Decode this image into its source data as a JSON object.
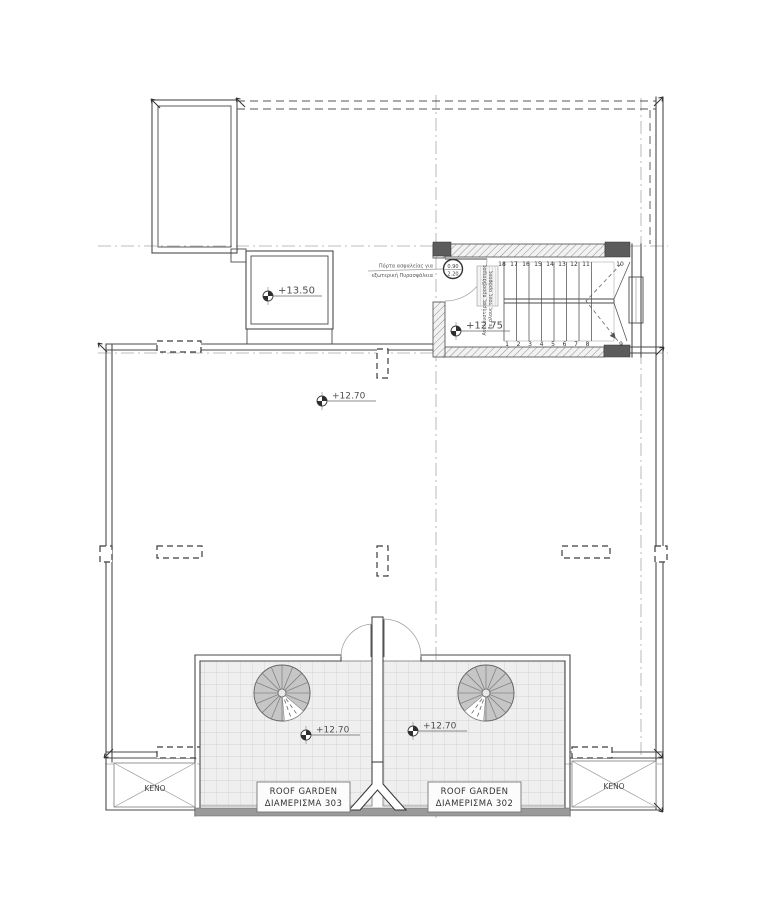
{
  "app": {
    "type": "architectural-floor-plan",
    "view": "roof plan"
  },
  "levels": {
    "stair_roof": "+13.50",
    "stair_landing": "+12.75",
    "main_roof": "+12.70",
    "garden_left": "+12.70",
    "garden_right": "+12.70"
  },
  "stair": {
    "top_run_numbers": [
      "18",
      "17",
      "16",
      "15",
      "14",
      "13",
      "12",
      "11"
    ],
    "corner_top_number": "10",
    "bottom_run_numbers": [
      "1",
      "2",
      "3",
      "4",
      "5",
      "6",
      "7",
      "8"
    ],
    "corner_bottom_number": "9",
    "door_tag_width": "0.90",
    "door_tag_height": "2.20"
  },
  "annotations": {
    "door_note_line1": "Πόρτα ασφαλείας για",
    "door_note_line2": "εξωτερική Πυρασφάλεια",
    "shaft_note_line1": "Ανελκυστήρας προσβάσιμος",
    "shaft_note_line2": "σε όλους τους ορόφους"
  },
  "rooms": {
    "garden_left_title": "ROOF GARDEN",
    "garden_left_subtitle": "ΔΙΑΜΕΡΙΣΜΑ 303",
    "garden_right_title": "ROOF GARDEN",
    "garden_right_subtitle": "ΔΙΑΜΕΡΙΣΜΑ 302",
    "void_left": "ΚΕΝΟ",
    "void_right": "ΚΕΝΟ"
  },
  "colors": {
    "line": "#4a4a4a",
    "light-line": "#9b9b9b",
    "axis": "#a8a8a8",
    "column-fill": "#5c5c5c",
    "garden-fill": "#efefef",
    "tile-line": "#c9c9c9",
    "spiral-fill": "#c6c6c6",
    "band": "#9a9a9a",
    "text": "#3f3f3f"
  }
}
